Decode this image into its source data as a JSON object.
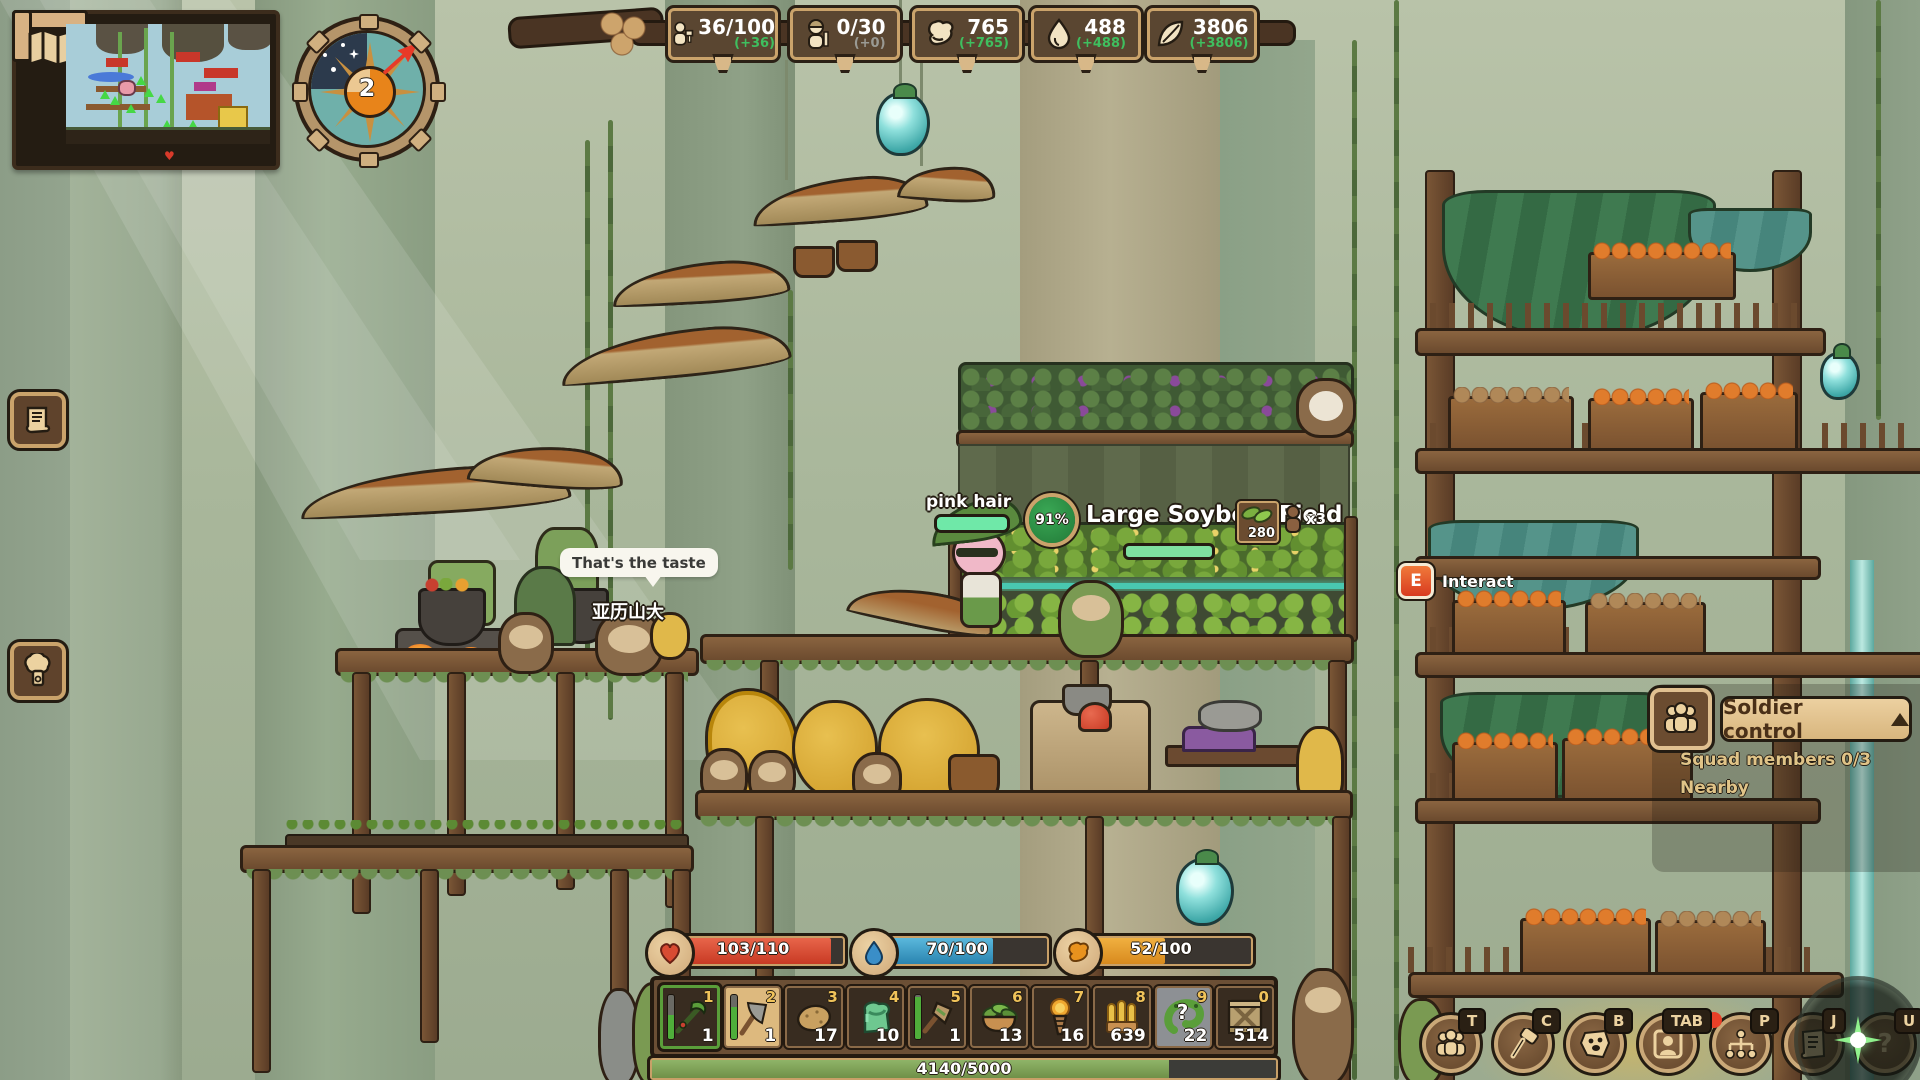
{
  "resources": {
    "items": [
      {
        "name": "workers",
        "value": "36/100",
        "delta": "(+36)"
      },
      {
        "name": "soldiers",
        "value": "0/30",
        "delta": "(+0)"
      },
      {
        "name": "food",
        "value": "765",
        "delta": "(+765)"
      },
      {
        "name": "water",
        "value": "488",
        "delta": "(+488)"
      },
      {
        "name": "plants",
        "value": "3806",
        "delta": "(+3806)"
      }
    ]
  },
  "compass": {
    "day_number": "2"
  },
  "world": {
    "speech_bubble": "That's the taste",
    "npc_name": "亚历山大",
    "player_name": "pink hair",
    "field": {
      "progress": "91%",
      "label": "Large SoybeanField",
      "yield": "280",
      "workers": "x3"
    },
    "interact": {
      "key": "E",
      "label": "Interact"
    }
  },
  "soldier_panel": {
    "title": "Soldier control",
    "squad": "Squad members 0/3",
    "nearby": "Nearby"
  },
  "status_bars": {
    "health": {
      "value": "103/110",
      "pct": 93.6,
      "color": "#d84b32"
    },
    "water": {
      "value": "70/100",
      "pct": 70,
      "color": "#3a9ec8"
    },
    "food": {
      "value": "52/100",
      "pct": 52,
      "color": "#e89a2e"
    }
  },
  "hotbar": {
    "slots": [
      {
        "key": "1",
        "count": "1",
        "icon": "green-scythe",
        "durability": 55
      },
      {
        "key": "2",
        "count": "1",
        "icon": "stone-axe",
        "durability": 72
      },
      {
        "key": "3",
        "count": "17",
        "icon": "potato"
      },
      {
        "key": "4",
        "count": "10",
        "icon": "goo-bag"
      },
      {
        "key": "5",
        "count": "1",
        "icon": "shovel",
        "durability": 95
      },
      {
        "key": "6",
        "count": "13",
        "icon": "salad-bowl"
      },
      {
        "key": "7",
        "count": "16",
        "icon": "torch"
      },
      {
        "key": "8",
        "count": "639",
        "icon": "ammo"
      },
      {
        "key": "9",
        "count": "22",
        "icon": "mystery-worm",
        "mark": "?"
      },
      {
        "key": "0",
        "count": "514",
        "icon": "wooden-crate"
      }
    ]
  },
  "xp": {
    "value": "4140/5000",
    "pct": 82.8
  },
  "quick_buttons": [
    {
      "key": "T",
      "icon": "squad"
    },
    {
      "key": "C",
      "icon": "craft-hammer"
    },
    {
      "key": "B",
      "icon": "creature"
    },
    {
      "key": "TAB",
      "icon": "character"
    },
    {
      "key": "P",
      "icon": "tech-tree",
      "notification": true
    },
    {
      "key": "J",
      "icon": "journal"
    },
    {
      "key": "U",
      "icon": "help",
      "glyph": "?"
    }
  ],
  "colors": {
    "accent_green": "#3fbf5f",
    "health": "#d84b32",
    "water": "#3a9ec8",
    "food": "#e89a2e",
    "xp_green": "#7fa055"
  }
}
